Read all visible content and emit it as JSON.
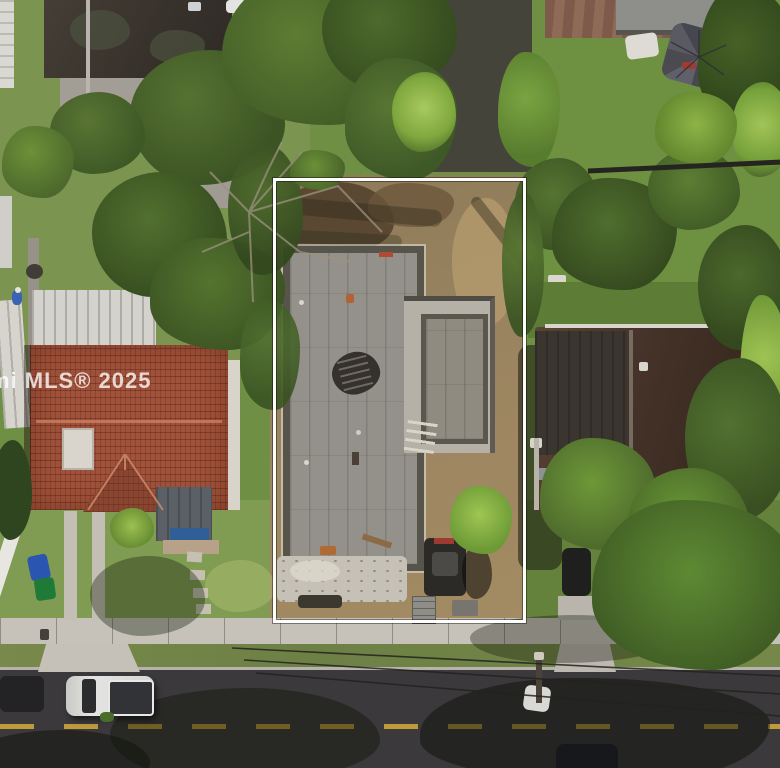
{
  "image": {
    "kind": "aerial-drone-real-estate-photo",
    "width_px": 780,
    "height_px": 768
  },
  "watermark": {
    "text": "mi MLS® 2025"
  },
  "palette": {
    "boundary_white": "#fdfdfb",
    "road_asphalt": "#3b393b",
    "lane_yellow": "#c9a23a",
    "sidewalk": "#c6c2ba",
    "concrete_slab": "#94908a",
    "slab_edge": "#57544c",
    "dirt": "#9a8460",
    "rubble": "#c6c1b6",
    "red_tile_roof": "#a0523a",
    "metal_roof": "#d3d2cc",
    "brown_roof": "#4a3629",
    "gray_roof": "#8e8e8b",
    "grass": "#6f8f44",
    "canopy_dark": "#3c5424",
    "canopy_bright": "#6fa23f",
    "truck_silver": "#dcdcda",
    "machine_dark": "#2b2a27"
  },
  "scene": {
    "subject": "vacant lot under construction outlined with white property boundary",
    "objects": [
      "property-boundary",
      "concrete-slab-roof",
      "construction-rubble",
      "skid-steer-loader",
      "red-tile-roof-house",
      "metal-roof-carport",
      "brown-roof-house",
      "gray-roof-house",
      "patio-umbrella",
      "pickup-truck",
      "road",
      "sidewalk",
      "driveway-strips",
      "trash-bins",
      "palm-trees",
      "tree-canopy",
      "power-lines",
      "utility-pole"
    ]
  }
}
